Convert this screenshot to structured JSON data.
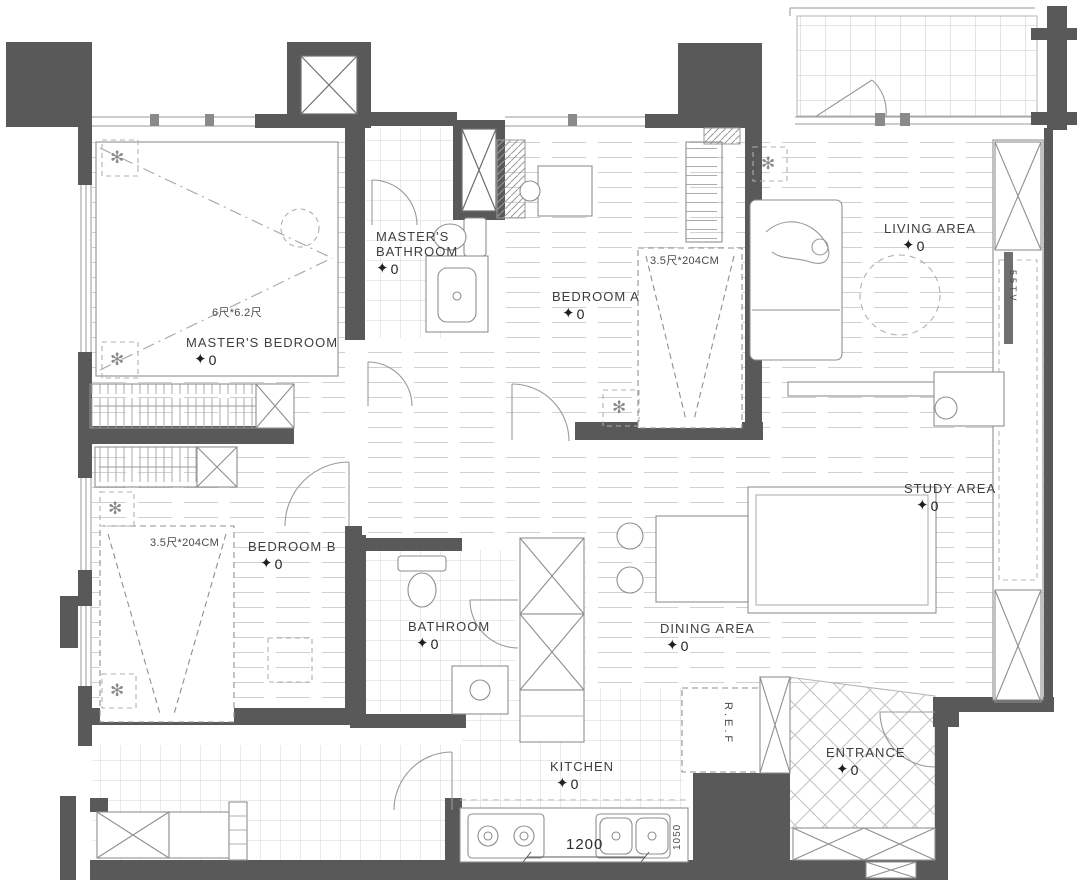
{
  "plan": {
    "colors": {
      "wall": "#595959",
      "line": "#8f8f8f",
      "floor_line": "#cdcdcd",
      "text": "#3e3e3e"
    },
    "icons": {
      "level_marker": "✦",
      "ceiling_fan": "✻"
    },
    "rooms": [
      {
        "id": "masters-bedroom",
        "label": "MASTER'S BEDROOM",
        "marker": "0"
      },
      {
        "id": "masters-bathroom",
        "label": "MASTER'S BATHROOM",
        "marker": "0"
      },
      {
        "id": "bedroom-a",
        "label": "BEDROOM A",
        "marker": "0"
      },
      {
        "id": "bedroom-b",
        "label": "BEDROOM B",
        "marker": "0"
      },
      {
        "id": "bathroom",
        "label": "BATHROOM",
        "marker": "0"
      },
      {
        "id": "living-area",
        "label": "LIVING AREA",
        "marker": "0"
      },
      {
        "id": "study-area",
        "label": "STUDY AREA",
        "marker": "0"
      },
      {
        "id": "dining-area",
        "label": "DINING AREA",
        "marker": "0"
      },
      {
        "id": "kitchen",
        "label": "KITCHEN",
        "marker": "0"
      },
      {
        "id": "entrance",
        "label": "ENTRANCE",
        "marker": "0"
      }
    ],
    "annotations": [
      {
        "id": "master-bed-size",
        "text": "6尺*6.2尺"
      },
      {
        "id": "bed-a-size",
        "text": "3.5尺*204CM"
      },
      {
        "id": "bed-b-size",
        "text": "3.5尺*204CM"
      },
      {
        "id": "refrigerator",
        "text": "R.E.F"
      },
      {
        "id": "tv",
        "text": "55TV"
      },
      {
        "id": "dim-1200",
        "text": "1200"
      },
      {
        "id": "dim-1050",
        "text": "1050"
      }
    ]
  }
}
